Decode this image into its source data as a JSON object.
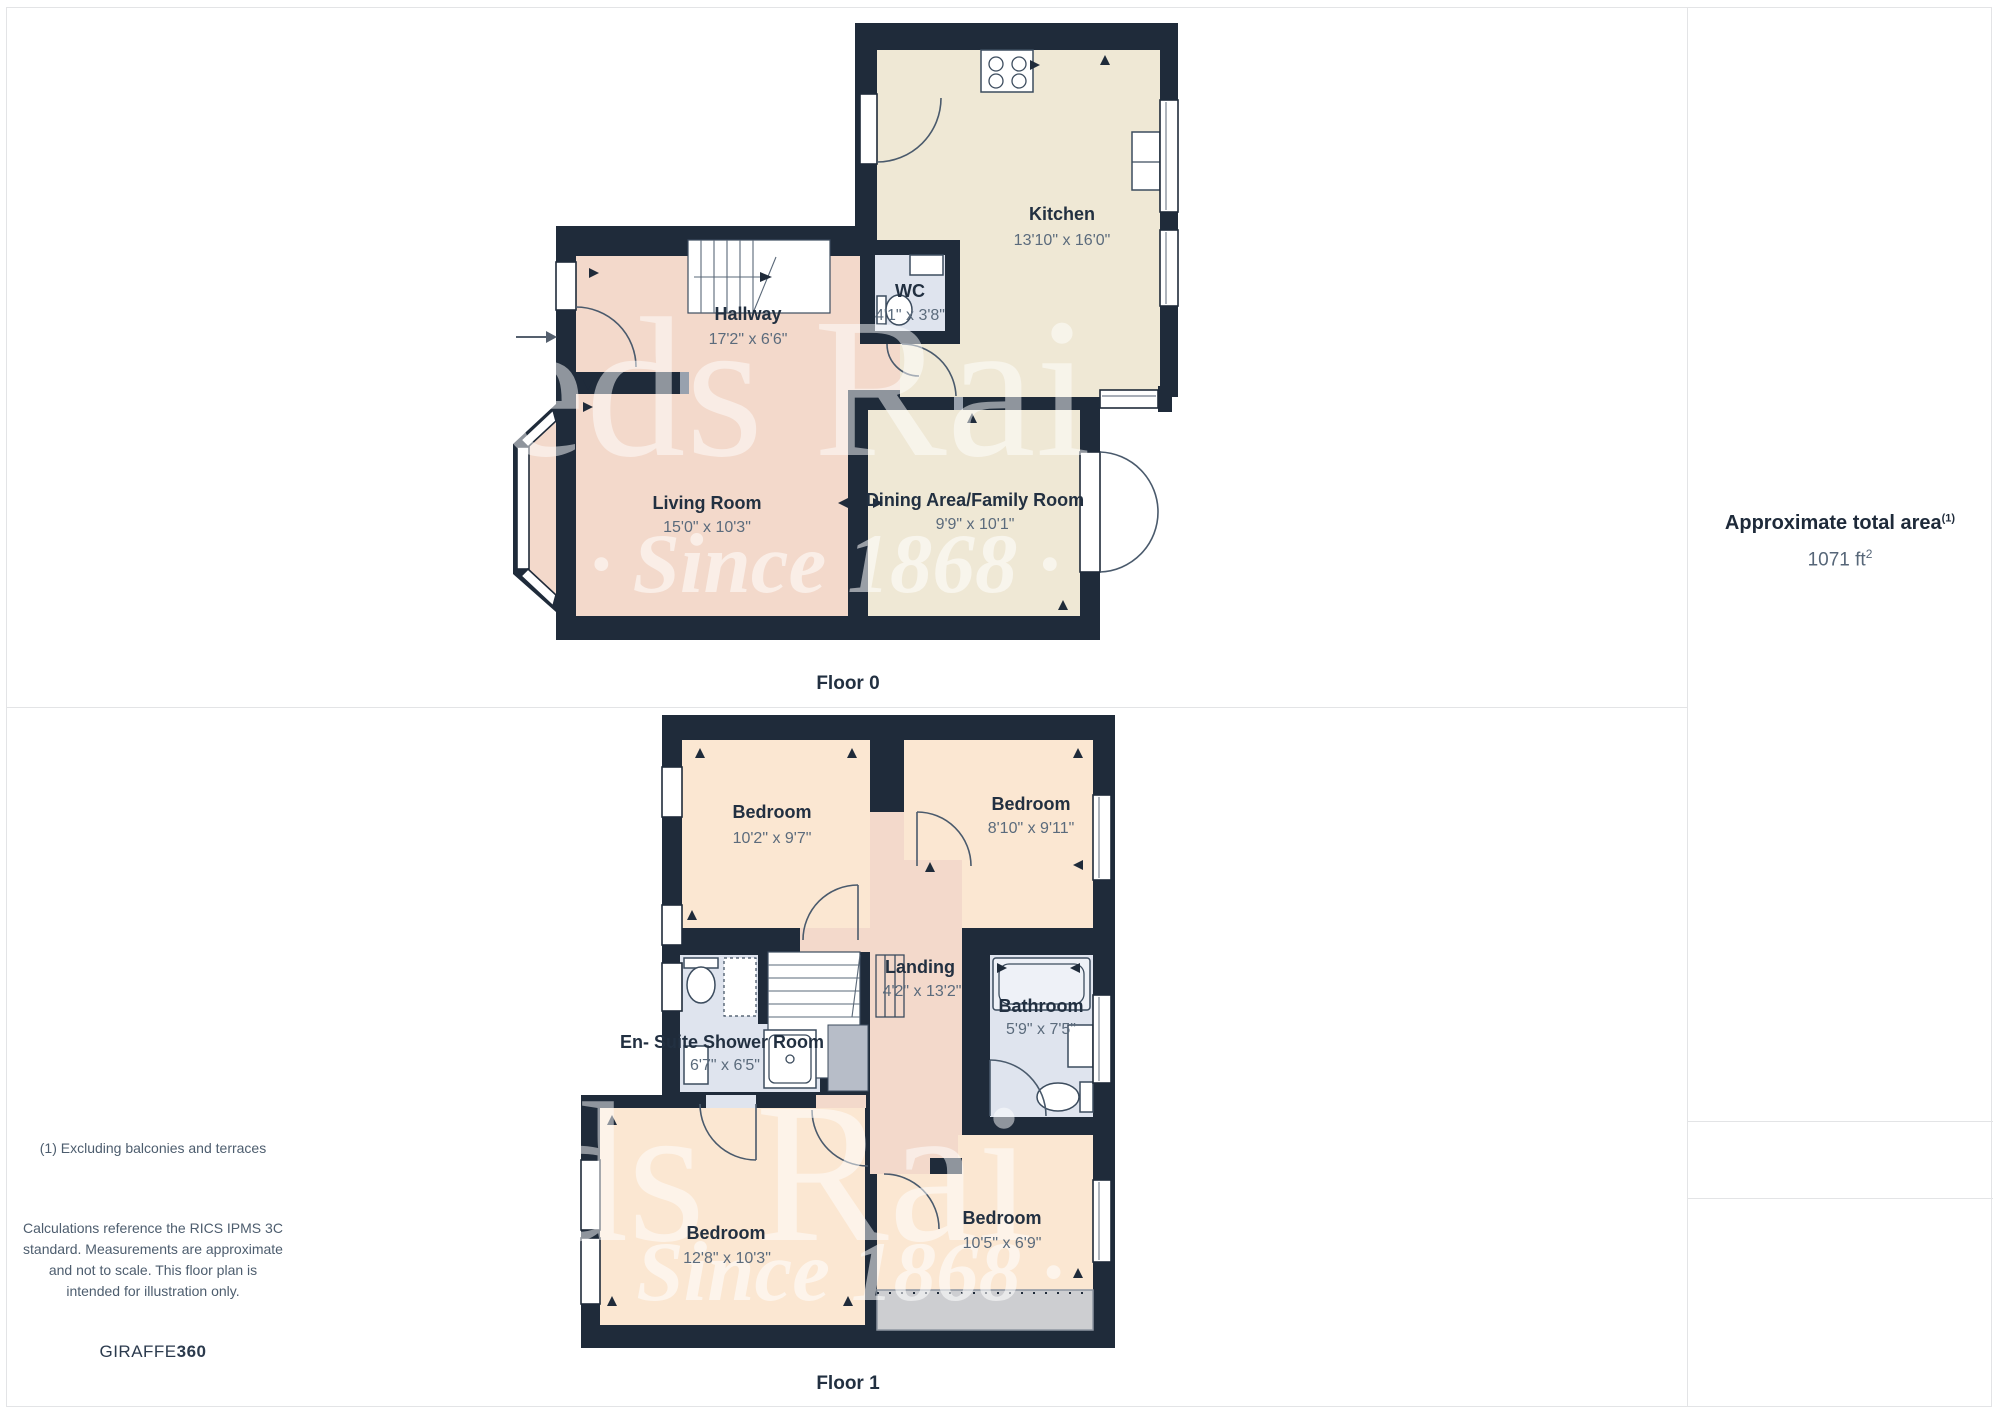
{
  "floor0": {
    "label": "Floor 0",
    "kitchen": {
      "name": "Kitchen",
      "dims": "13'10\" x 16'0\""
    },
    "wc": {
      "name": "WC",
      "dims": "4'1\" x 3'8\""
    },
    "hallway": {
      "name": "Hallway",
      "dims": "17'2\" x 6'6\""
    },
    "living": {
      "name": "Living Room",
      "dims": "15'0\" x 10'3\""
    },
    "dining": {
      "name": "Dining Area/Family Room",
      "dims": "9'9\" x 10'1\""
    }
  },
  "floor1": {
    "label": "Floor 1",
    "bedroom_tl": {
      "name": "Bedroom",
      "dims": "10'2\" x 9'7\""
    },
    "bedroom_tr": {
      "name": "Bedroom",
      "dims": "8'10\" x 9'11\""
    },
    "landing": {
      "name": "Landing",
      "dims": "4'2\" x 13'2\""
    },
    "bathroom": {
      "name": "Bathroom",
      "dims": "5'9\" x 7'5\""
    },
    "ensuite": {
      "name": "En- Suite Shower Room",
      "dims": "6'7\" x 6'5\""
    },
    "bedroom_bl": {
      "name": "Bedroom",
      "dims": "12'8\" x 10'3\""
    },
    "bedroom_br": {
      "name": "Bedroom",
      "dims": "10'5\" x 6'9\""
    }
  },
  "sidebar": {
    "area_title": "Approximate total area",
    "area_title_sup": "(1)",
    "area_value_number": "1071 ft",
    "area_value_sup": "2",
    "footnote": "(1) Excluding balconies and terraces",
    "disclaimer": "Calculations reference the RICS IPMS 3C standard. Measurements are approximate and not to scale. This floor plan is intended for illustration only.",
    "brand_name": "GIRAFFE",
    "brand_suffix": "360"
  },
  "watermark": {
    "serif_text": "eeds Rai",
    "script_text_floor0": "· Since 1868 ·",
    "script_text_floor1": "Since 1868 ·"
  },
  "colors": {
    "wall": "#1f2b3a",
    "hall_pink": "#f3d9cb",
    "kitchen_beige": "#efe8d5",
    "bedroom_peach": "#fbe7d2",
    "bath_blue": "#dfe4ee",
    "terrace_gray": "#cdced1",
    "label_dark": "#223041",
    "dims_gray": "#5b6b7c",
    "divider_gray": "#e3e4e6"
  }
}
